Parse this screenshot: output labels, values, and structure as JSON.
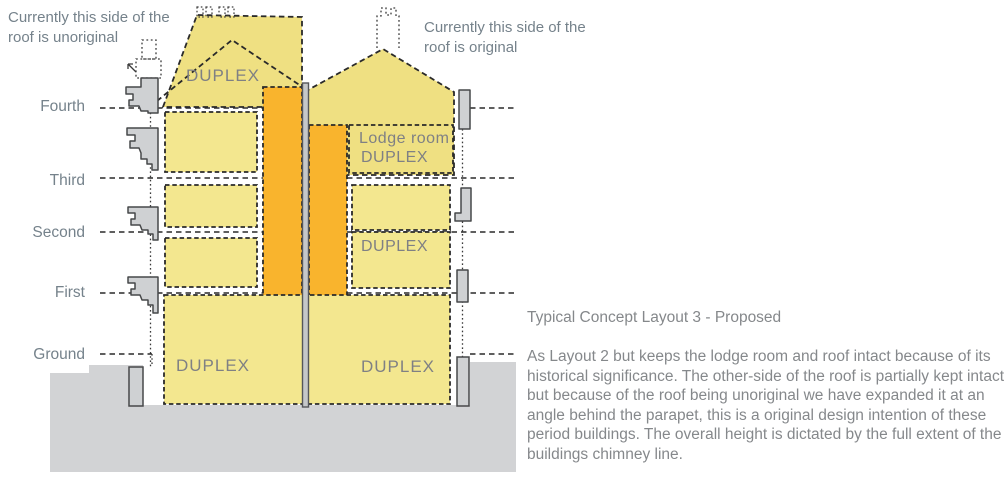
{
  "diagram": {
    "notes": {
      "left_line1": "Currently this side of the",
      "left_line2": "roof is unoriginal",
      "right_line1": "Currently this side of the",
      "right_line2": "roof is original"
    },
    "floor_labels": {
      "fourth": "Fourth",
      "third": "Third",
      "second": "Second",
      "first": "First",
      "ground": "Ground"
    },
    "room_labels": {
      "roof_duplex": "DUPLEX",
      "lodge_room_line1": "Lodge room",
      "lodge_room_line2": "DUPLEX",
      "right_duplex": "DUPLEX",
      "bottom_left_duplex": "DUPLEX",
      "bottom_right_duplex": "DUPLEX"
    },
    "colors": {
      "unit_yellow": "#F3E78F",
      "roof_yellow": "#EFE082",
      "core_orange": "#F9B42D",
      "ground_gray": "#D2D3D5",
      "outline_dark": "#2A2A2A",
      "text_gray": "#85888B"
    }
  },
  "description": {
    "title": "Typical Concept Layout 3 - Proposed",
    "body": "As Layout 2 but keeps the lodge room and roof intact because of its historical significance. The other-side of the roof is partially kept intact but because of the roof being unoriginal we have expanded it at an angle behind the parapet, this is a original design intention of these period buildings. The overall height is dictated by the full extent of the buildings chimney line."
  }
}
